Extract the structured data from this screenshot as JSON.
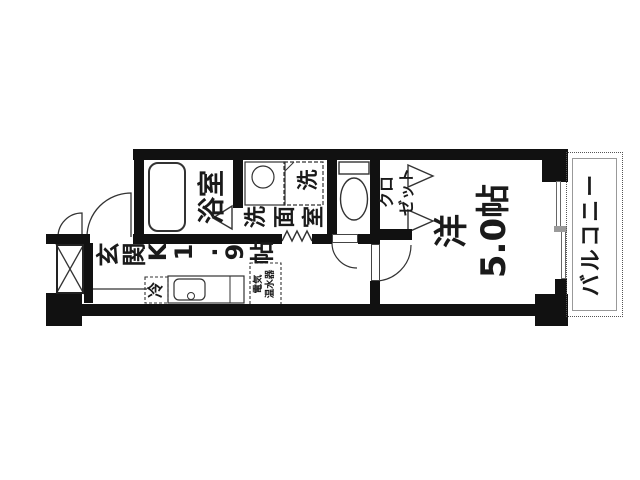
{
  "colors": {
    "wall": "#111111",
    "line": "#333333",
    "background": "#ffffff"
  },
  "rooms": {
    "genkan": {
      "label": "玄関"
    },
    "kitchen": {
      "label": "K1.9帖"
    },
    "bathroom": {
      "label": "浴室"
    },
    "washroom": {
      "label": "洗面室"
    },
    "washer": {
      "label": "洗"
    },
    "fridge": {
      "label": "冷"
    },
    "water_heater": {
      "label": "電気\n温水器"
    },
    "closet": {
      "label": "クロ\nゼット"
    },
    "western_room": {
      "label": "洋\n5.0帖"
    },
    "balcony": {
      "label": "バルコニー"
    }
  }
}
